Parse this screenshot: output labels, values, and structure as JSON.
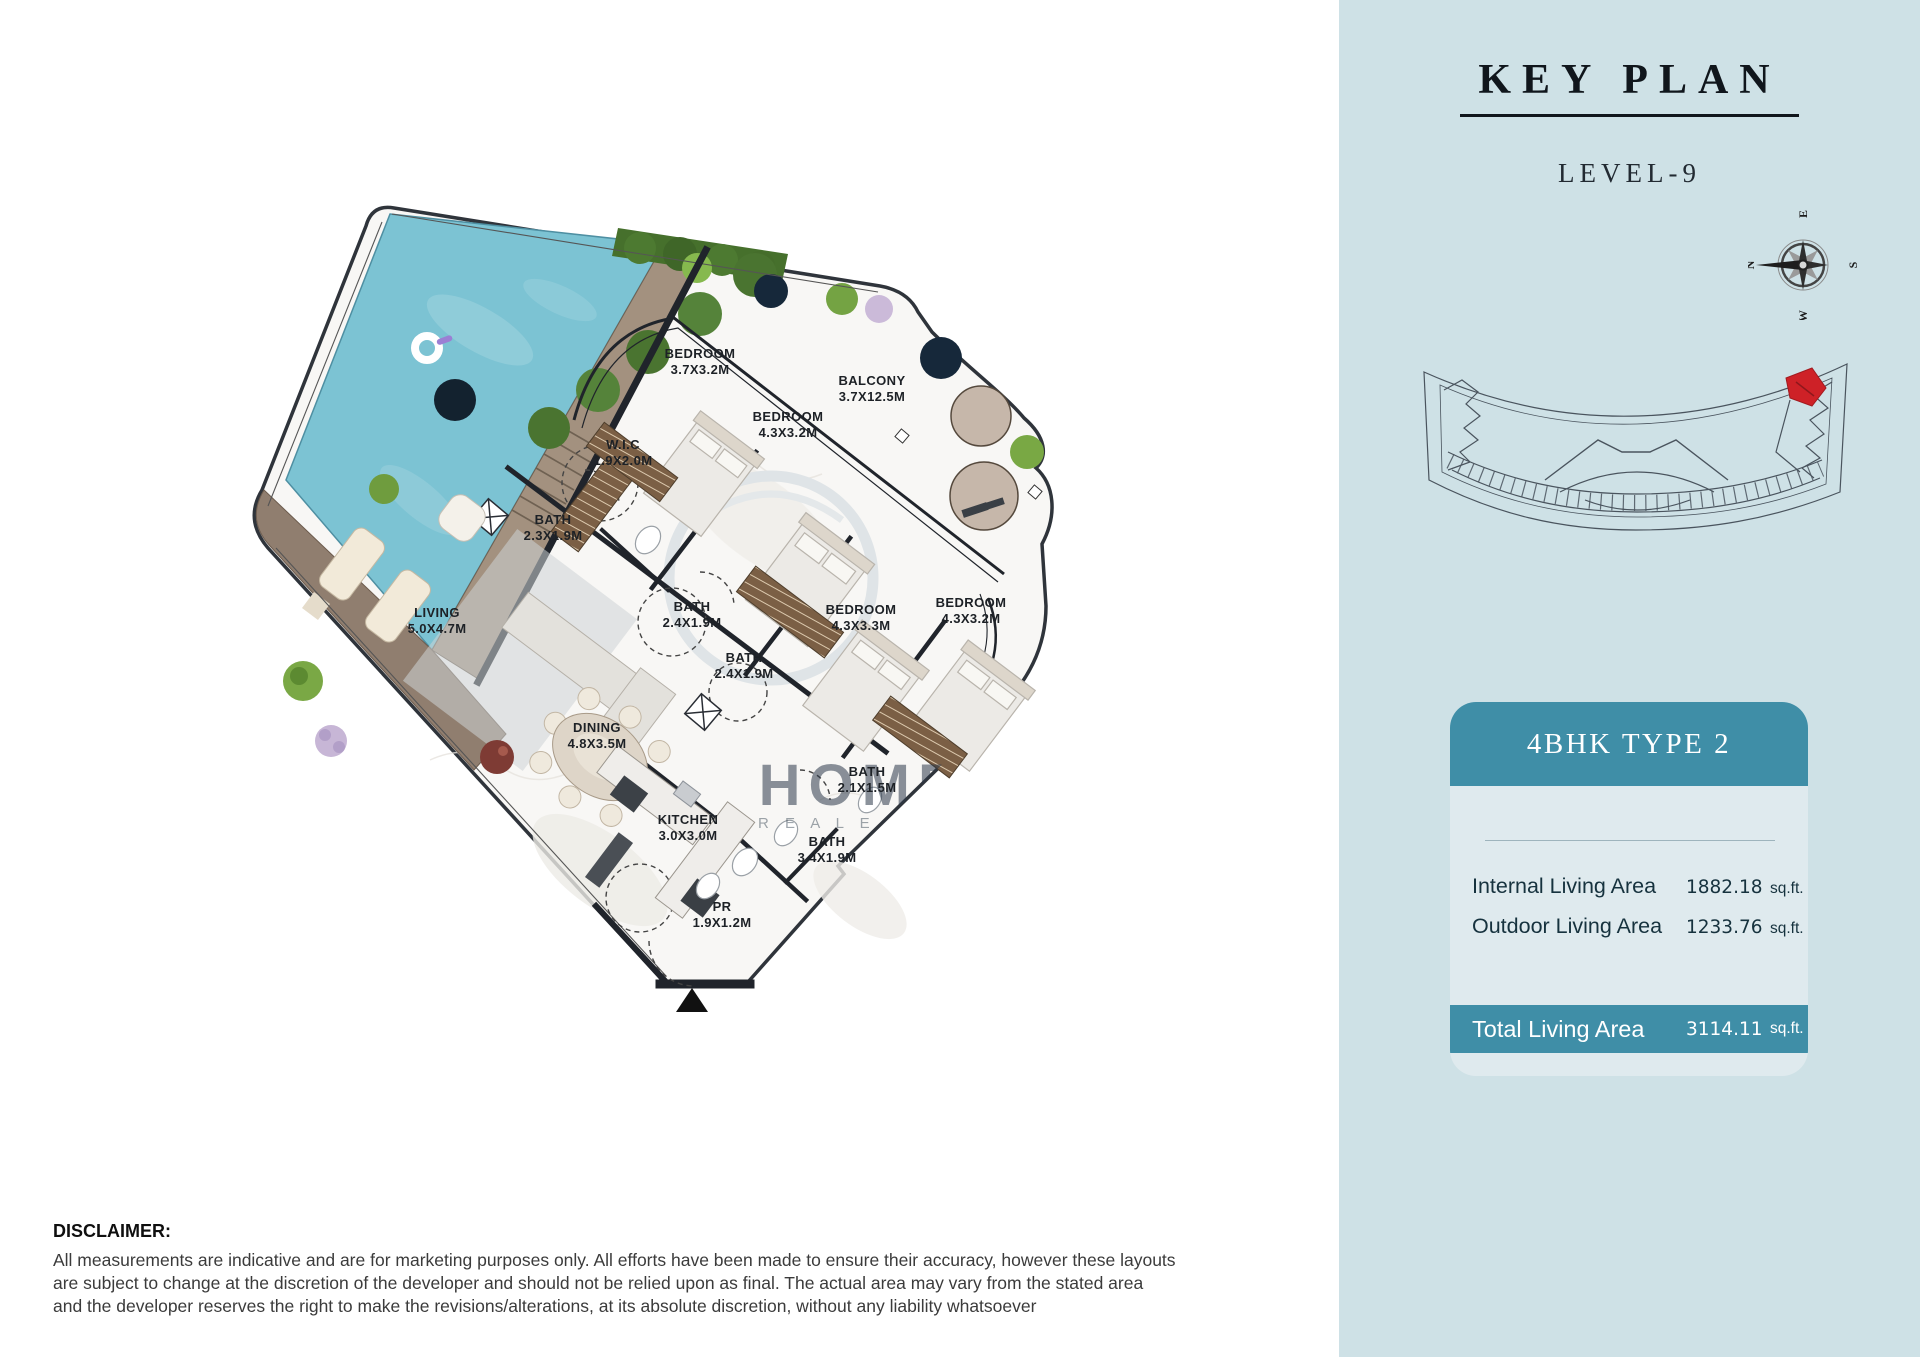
{
  "header": {
    "title": "KEY PLAN",
    "level": "LEVEL-9"
  },
  "compass": {
    "n": "N",
    "e": "E",
    "s": "S",
    "w": "W"
  },
  "unit_card": {
    "title": "4BHK TYPE 2",
    "rows": [
      {
        "label": "Internal Living Area",
        "value": "1882.18",
        "unit": "sq.ft."
      },
      {
        "label": "Outdoor Living Area",
        "value": "1233.76",
        "unit": "sq.ft."
      }
    ],
    "total": {
      "label": "Total Living Area",
      "value": "3114.11",
      "unit": "sq.ft."
    }
  },
  "floor_plan": {
    "rooms": [
      {
        "name": "BEDROOM",
        "dims": "3.7X3.2M",
        "x": 700,
        "y": 358
      },
      {
        "name": "BALCONY",
        "dims": "3.7X12.5M",
        "x": 872,
        "y": 385
      },
      {
        "name": "BEDROOM",
        "dims": "4.3X3.2M",
        "x": 788,
        "y": 421
      },
      {
        "name": "W.I.C",
        "dims": "1.9X2.0M",
        "x": 623,
        "y": 449
      },
      {
        "name": "BATH",
        "dims": "2.3X1.9M",
        "x": 553,
        "y": 524
      },
      {
        "name": "LIVING",
        "dims": "5.0X4.7M",
        "x": 437,
        "y": 617
      },
      {
        "name": "BATH",
        "dims": "2.4X1.9M",
        "x": 692,
        "y": 611
      },
      {
        "name": "BATH",
        "dims": "2.4X1.9M",
        "x": 744,
        "y": 662
      },
      {
        "name": "BEDROOM",
        "dims": "4.3X3.3M",
        "x": 861,
        "y": 614
      },
      {
        "name": "BEDROOM",
        "dims": "4.3X3.2M",
        "x": 971,
        "y": 607
      },
      {
        "name": "DINING",
        "dims": "4.8X3.5M",
        "x": 597,
        "y": 732
      },
      {
        "name": "KITCHEN",
        "dims": "3.0X3.0M",
        "x": 688,
        "y": 824
      },
      {
        "name": "BATH",
        "dims": "2.1X1.5M",
        "x": 867,
        "y": 776
      },
      {
        "name": "BATH",
        "dims": "3.4X1.9M",
        "x": 827,
        "y": 846
      },
      {
        "name": "PR",
        "dims": "1.9X1.2M",
        "x": 722,
        "y": 911
      }
    ],
    "watermark": {
      "line1": "HOMES",
      "line2": "R E A L  E S T A T E"
    }
  },
  "disclaimer": {
    "title": "DISCLAIMER:",
    "lines": [
      "All measurements are indicative and are for marketing purposes only. All efforts have been made to ensure their accuracy, however these layouts",
      "are subject to change at the discretion of the developer and should not be relied upon as final. The actual area may vary from the stated area",
      "and the developer reserves the right to make the revisions/alterations, at its absolute discretion, without any liability whatsoever"
    ]
  },
  "colors": {
    "panel_bg": "#CEE1E6",
    "accent_teal": "#3F8EA7",
    "card_body": "#DFEAEE",
    "pool": "#7CC3D3",
    "deck": "#A3917F",
    "terrace": "#907E6F",
    "wall": "#20242B",
    "highlight_red": "#CE2127"
  }
}
